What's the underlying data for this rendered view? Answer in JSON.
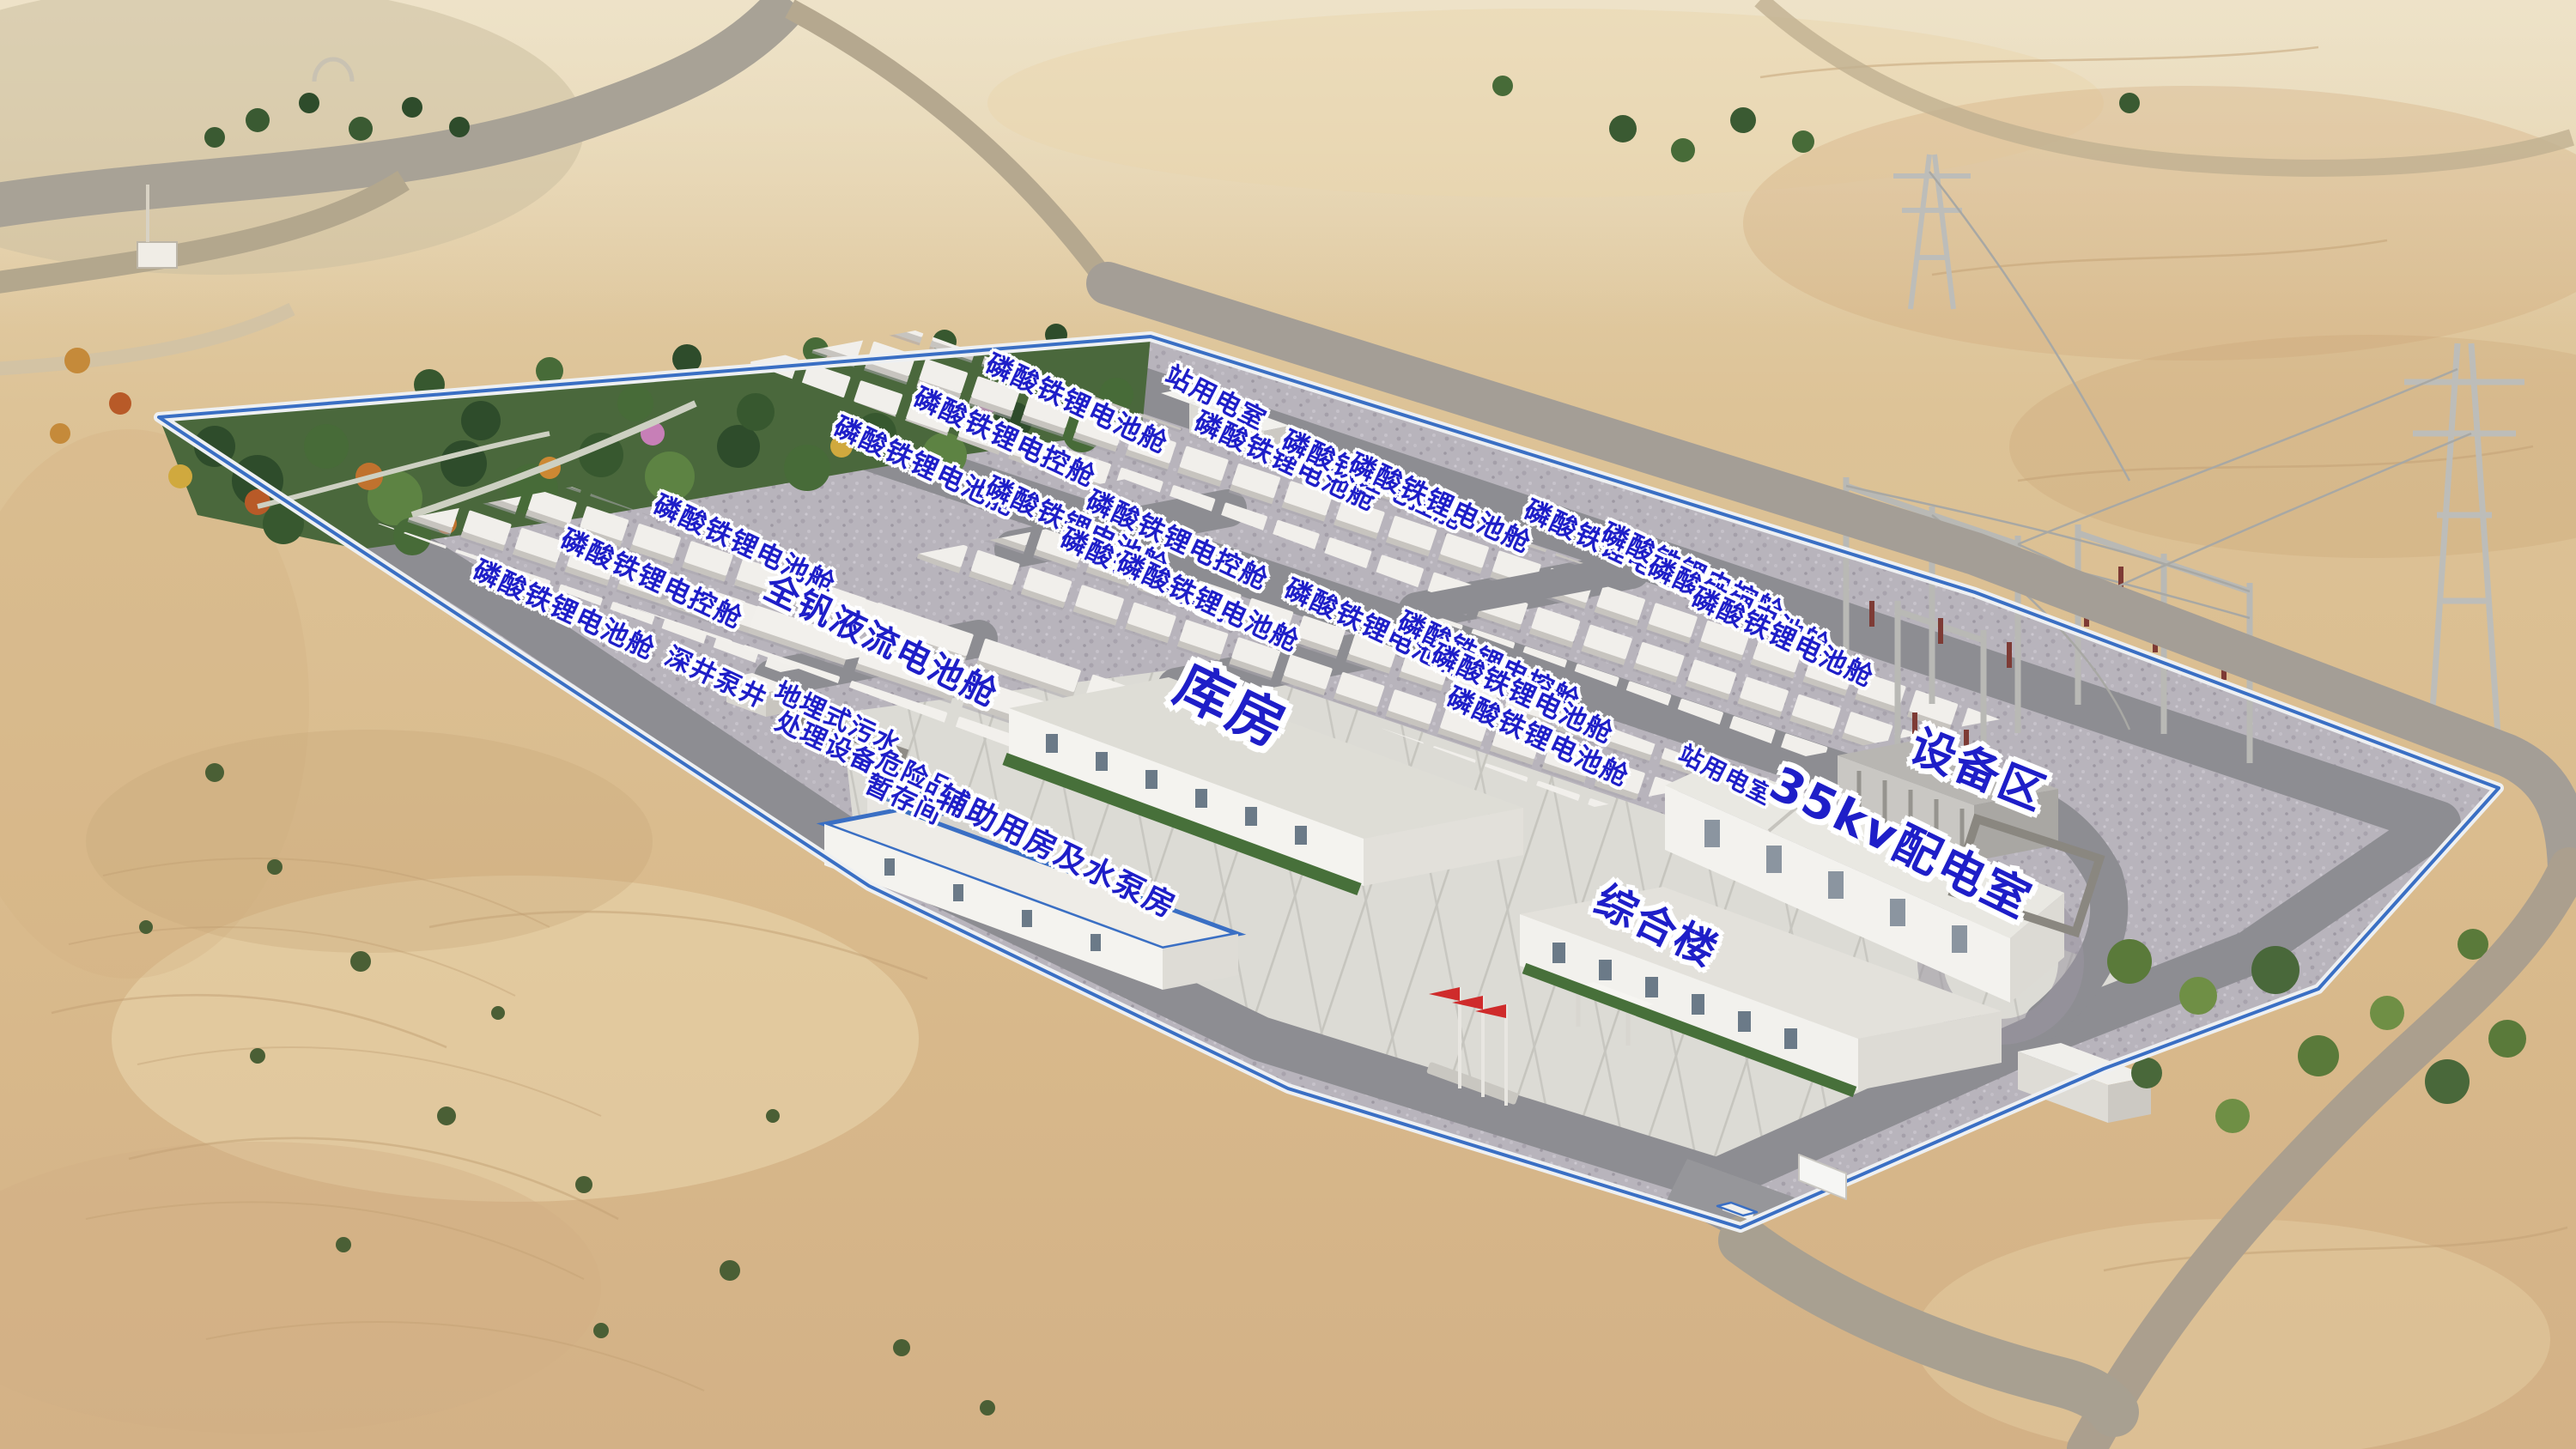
{
  "meta": {
    "description": "Aerial 3D rendering of a desert energy storage power station with blue facility labels",
    "language": "zh-CN"
  },
  "colors": {
    "label_blue": "#1e1ec8",
    "label_outline": "#ffffff",
    "wall_trim_blue": "#3a6fc4",
    "sand": "#d9bc90",
    "gravel": "#b8b4bc",
    "asphalt_road": "#8d8d92",
    "plaza_concrete": "#dcdbd5",
    "container_white": "#f1efeb",
    "tree_green": "#476b38",
    "flag_red": "#cf2b2b"
  },
  "labels": [
    {
      "id": "station-power-cabin",
      "text": "站用电室",
      "x": 47.2,
      "y": 27.5,
      "size": 30,
      "rotate": 27
    },
    {
      "id": "lfp-battery-a1",
      "text": "磷酸铁锂电池舱",
      "x": 41.8,
      "y": 27.9,
      "size": 31,
      "rotate": 25
    },
    {
      "id": "lfp-control-a2",
      "text": "磷酸铁锂电控舱",
      "x": 39.0,
      "y": 30.2,
      "size": 31,
      "rotate": 25
    },
    {
      "id": "lfp-battery-a3",
      "text": "磷酸铁锂电池舱",
      "x": 35.9,
      "y": 32.2,
      "size": 31,
      "rotate": 25
    },
    {
      "id": "lfp-battery-b1",
      "text": "磷酸铁锂电池舱",
      "x": 49.9,
      "y": 31.9,
      "size": 31,
      "rotate": 25
    },
    {
      "id": "lfp-control-b2",
      "text": "磷酸铁锂电控舱",
      "x": 53.3,
      "y": 33.2,
      "size": 31,
      "rotate": 25
    },
    {
      "id": "lfp-battery-b3",
      "text": "磷酸铁锂电池舱",
      "x": 55.9,
      "y": 34.8,
      "size": 31,
      "rotate": 25
    },
    {
      "id": "lfp-battery-c1",
      "text": "磷酸铁锂电池舱",
      "x": 28.9,
      "y": 37.6,
      "size": 31,
      "rotate": 25
    },
    {
      "id": "lfp-control-c2",
      "text": "磷酸铁锂电控舱",
      "x": 25.3,
      "y": 40.0,
      "size": 31,
      "rotate": 25
    },
    {
      "id": "lfp-battery-c3",
      "text": "磷酸铁锂电池舱",
      "x": 21.9,
      "y": 42.1,
      "size": 31,
      "rotate": 25
    },
    {
      "id": "lfp-battery-d1",
      "text": "磷酸铁锂电池舱",
      "x": 62.7,
      "y": 38.0,
      "size": 31,
      "rotate": 25
    },
    {
      "id": "lfp-control-d2",
      "text": "磷酸铁锂电控舱",
      "x": 65.7,
      "y": 39.6,
      "size": 31,
      "rotate": 25
    },
    {
      "id": "lfp-battery-d3",
      "text": "磷酸铁锂电池舱",
      "x": 67.5,
      "y": 41.9,
      "size": 31,
      "rotate": 25
    },
    {
      "id": "lfp-battery-d4",
      "text": "磷酸铁锂电池舱",
      "x": 69.2,
      "y": 44.0,
      "size": 31,
      "rotate": 25
    },
    {
      "id": "lfp-battery-e1",
      "text": "磷酸铁锂电池舱",
      "x": 41.8,
      "y": 36.4,
      "size": 31,
      "rotate": 25
    },
    {
      "id": "lfp-control-e2",
      "text": "磷酸铁锂电控舱",
      "x": 45.7,
      "y": 37.3,
      "size": 31,
      "rotate": 25
    },
    {
      "id": "lfp-battery-e3",
      "text": "磷酸铁锂电池舱",
      "x": 44.7,
      "y": 39.9,
      "size": 31,
      "rotate": 25
    },
    {
      "id": "lfp-battery-e4",
      "text": "磷酸铁锂电池舱",
      "x": 46.9,
      "y": 41.6,
      "size": 31,
      "rotate": 25
    },
    {
      "id": "lfp-battery-f1",
      "text": "磷酸铁锂电池舱",
      "x": 53.4,
      "y": 43.4,
      "size": 31,
      "rotate": 25
    },
    {
      "id": "lfp-control-f2",
      "text": "磷酸铁锂电控舱",
      "x": 57.8,
      "y": 45.7,
      "size": 31,
      "rotate": 25
    },
    {
      "id": "lfp-battery-f3",
      "text": "磷酸铁锂电池舱",
      "x": 59.1,
      "y": 47.9,
      "size": 31,
      "rotate": 25
    },
    {
      "id": "lfp-battery-f4",
      "text": "磷酸铁锂电池舱",
      "x": 59.7,
      "y": 50.9,
      "size": 31,
      "rotate": 25
    },
    {
      "id": "vanadium-flow-battery",
      "text": "全钒液流电池舱",
      "x": 34.2,
      "y": 44.3,
      "size": 40,
      "rotate": 26
    },
    {
      "id": "deep-well-pump",
      "text": "深井泵井",
      "x": 27.8,
      "y": 46.8,
      "size": 30,
      "rotate": 25
    },
    {
      "id": "buried-sewage-treatment",
      "text": "地埋式污水\n处理设备",
      "x": 32.3,
      "y": 50.5,
      "size": 30,
      "rotate": 25
    },
    {
      "id": "hazmat-storage",
      "text": "危险品\n暂存间",
      "x": 35.3,
      "y": 54.4,
      "size": 30,
      "rotate": 25
    },
    {
      "id": "auxiliary-pump-house",
      "text": "辅助用房及水泵房",
      "x": 41.0,
      "y": 58.8,
      "size": 36,
      "rotate": 26
    },
    {
      "id": "warehouse",
      "text": "库房",
      "x": 47.8,
      "y": 48.8,
      "size": 64,
      "rotate": 26
    },
    {
      "id": "office-building",
      "text": "综合楼",
      "x": 64.3,
      "y": 64.0,
      "size": 48,
      "rotate": 26
    },
    {
      "id": "station-power-room-roof",
      "text": "站用电室",
      "x": 67.0,
      "y": 53.5,
      "size": 28,
      "rotate": 27
    },
    {
      "id": "distribution-room-35kv",
      "text": "35kv配电室",
      "x": 73.8,
      "y": 58.2,
      "size": 54,
      "rotate": 26
    },
    {
      "id": "equipment-area",
      "text": "设备区",
      "x": 76.8,
      "y": 53.2,
      "size": 52,
      "rotate": 22
    }
  ]
}
